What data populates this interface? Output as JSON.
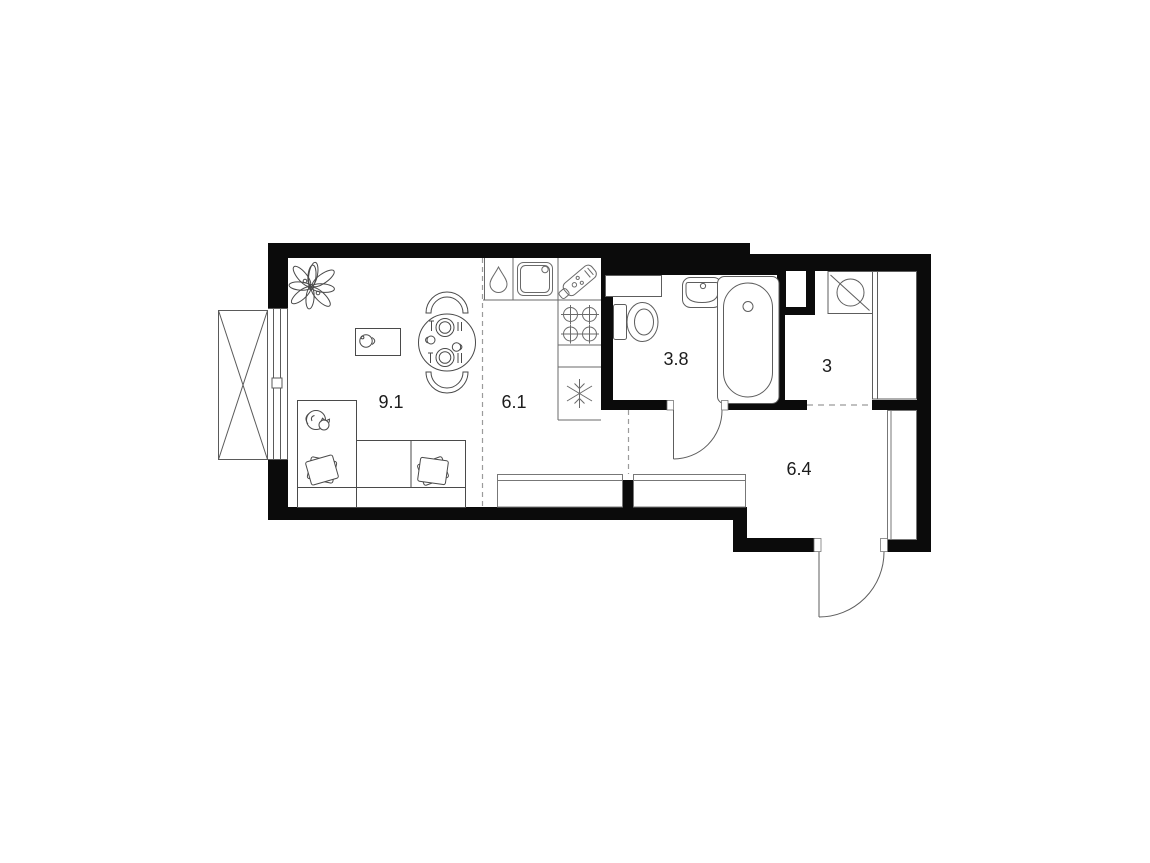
{
  "meta": {
    "type": "apartment-floor-plan"
  },
  "colors": {
    "background": "#ffffff",
    "walls": "#0b0b0b",
    "furniture_line": "#4a4a4a",
    "fixture_line": "#666666",
    "dashed_line": "#9b9b9b",
    "label_text": "#1c1c1c"
  },
  "rooms": [
    {
      "id": "living-room",
      "area": "9.1"
    },
    {
      "id": "kitchen",
      "area": "6.1"
    },
    {
      "id": "bathroom",
      "area": "3.8"
    },
    {
      "id": "wardrobe-room",
      "area": "3"
    },
    {
      "id": "hallway",
      "area": "6.4"
    }
  ],
  "icons": {
    "plant-icon": "leaf-cluster",
    "cat-icon": "curled-cat",
    "cup-icon": "cup-with-handle",
    "dining-set-icon": "round-table-two-chairs-plates",
    "water-drop-icon": "droplet",
    "kitchen-sink-icon": "basin-with-tap-hole",
    "cutting-board-icon": "board-with-handle",
    "stove-icon": "four-crossed-burners",
    "fridge-icon": "snowflake",
    "toilet-icon": "tank-and-bowl",
    "washbasin-icon": "rounded-basin",
    "bathtub-icon": "oval-tub-with-drain",
    "washing-machine-icon": "drum-with-diagonal-stroke",
    "wardrobe-icon": "tall-rectangle",
    "closet-icon": "low-rectangle",
    "balcony-icon": "crossed-rectangle",
    "door-icon": "quarter-circle-swing"
  }
}
